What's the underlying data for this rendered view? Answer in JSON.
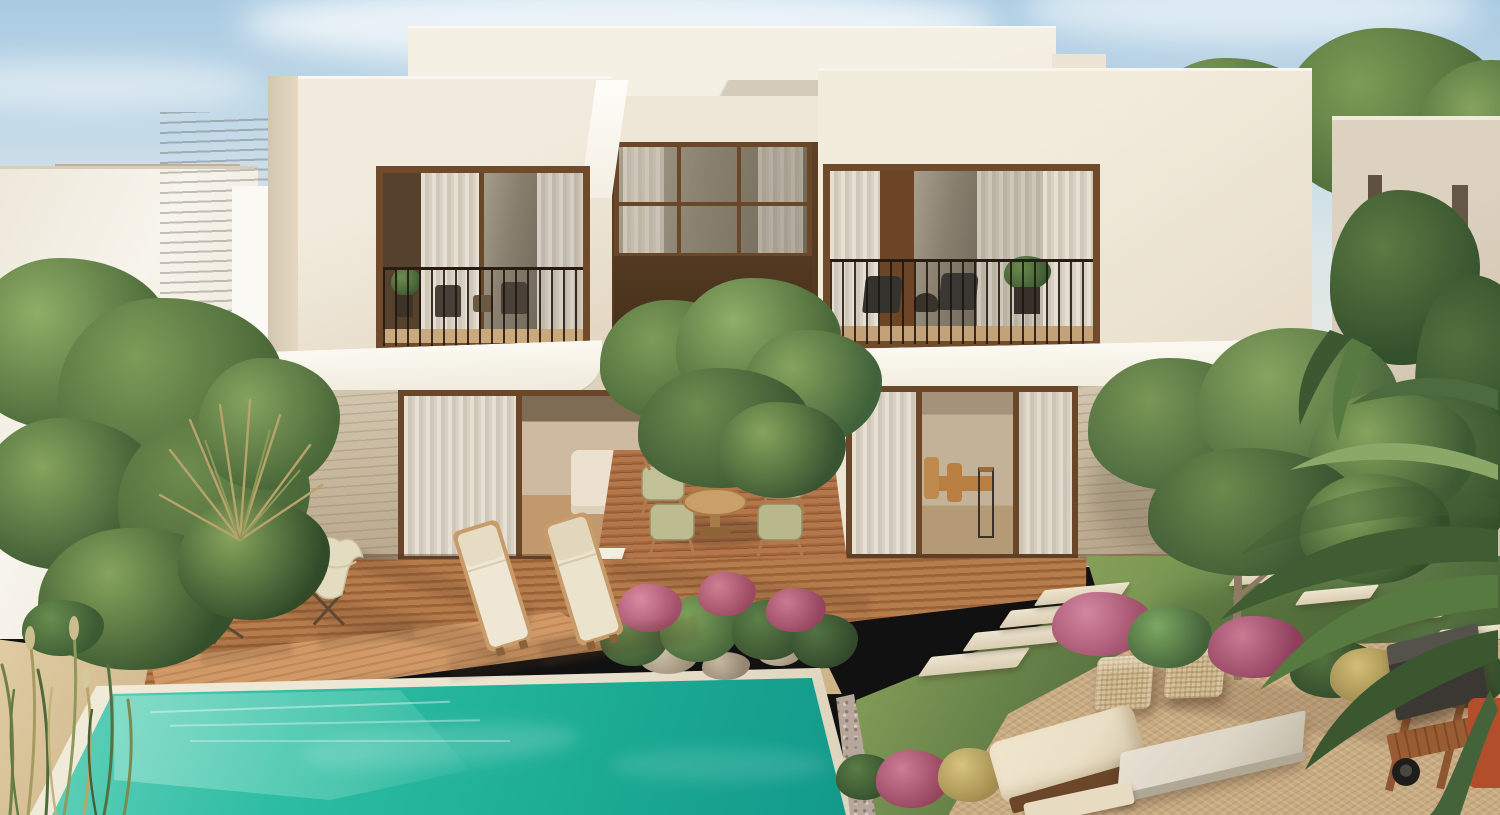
{
  "scene": {
    "type": "photorealistic architectural rendering",
    "description": "Rear garden view of a modern two-storey cream desert villa with two recessed balconies, brown-framed glazing, a travertine ground floor, a frangipani courtyard tree over a timber deck, sun loungers and butterfly chairs beside a turquoise pool, and a lawn with stepping stones leading to a gravel lounge patio framed by palms and pink ornamental grasses.",
    "time_of_day": "late afternoon sunlight from the left",
    "palette": {
      "sky_top": "#a9cbe2",
      "sky_horizon": "#e9e9df",
      "wall_cream": "#f1ebdd",
      "wall_shadow": "#ddd0ba",
      "fascia_white": "#faf7ef",
      "frame_brown": "#6b4729",
      "panel_dark_brown": "#46311e",
      "travertine": "#c9b99c",
      "deck_wood": "#b57c4c",
      "deck_wood_dark": "#9c6036",
      "pool_turquoise": "#2dbda4",
      "pool_deep": "#12998b",
      "pool_steps": "#8eddc8",
      "coping_stone": "#ebe4d1",
      "sand": "#d9c39a",
      "lawn_green": "#6f8f4f",
      "lawn_shadow": "#466033",
      "gravel_tan": "#c9ab82",
      "foliage_light": "#86a45c",
      "foliage_dark": "#4a6838",
      "flower_pink": "#c06a80",
      "cushion_cream": "#eadfc6",
      "accent_burgundy": "#8e4b44",
      "grill_black": "#3b3833"
    },
    "objects": [
      "sky",
      "clouds",
      "desert-dune-horizon",
      "neighbouring-villas",
      "garden-trees",
      "two-storey-villa",
      "left-balcony",
      "right-balcony",
      "courtyard-window",
      "frangipani-courtyard-tree",
      "outdoor-dining-set",
      "travertine-walls",
      "sliding-glass-doors",
      "living-room-interior",
      "dining-room-interior",
      "timber-deck",
      "sun-loungers",
      "butterfly-chairs",
      "burgundy-side-table",
      "swimming-pool",
      "pool-steps",
      "flower-bed-with-rocks",
      "lawn",
      "stepping-stones",
      "gravel-patio",
      "wicker-poufs",
      "floor-cushion",
      "stone-coffee-table",
      "olive-tree",
      "palm-fronds",
      "pink-ornamental-grasses",
      "barbecue-cart",
      "tall-grasses"
    ]
  }
}
